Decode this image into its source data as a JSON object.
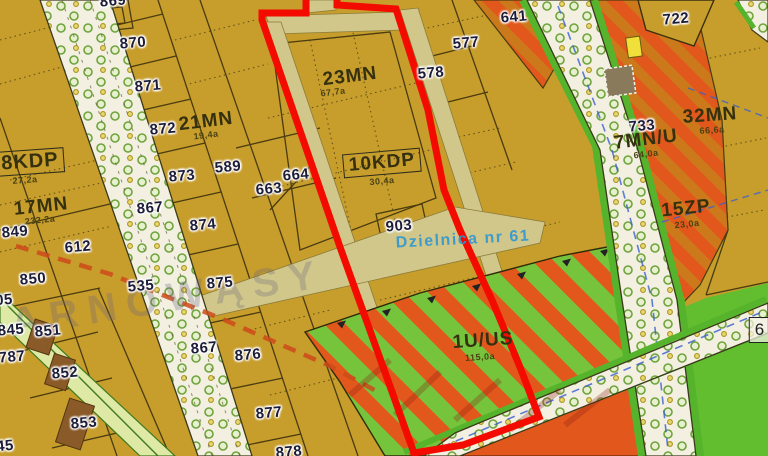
{
  "map": {
    "kind": "zoning-plan-extract",
    "district_note": "Dzielnica nr 61",
    "watermark": "ARNOWĄSY",
    "colors": {
      "parcel_base": "#c79d2c",
      "road_reserve_khaki": "#d2c78a",
      "street_white": "#f3f0e2",
      "service_orange": "#e2581c",
      "sport_green": "#76c43c",
      "park_green": "#62be2f",
      "green_strip": "#55b42c",
      "selection_red": "#f30b00",
      "infra_dash_red": "#cc4a1a",
      "utility_dash_blue": "#3a5fd0",
      "building_brown": "#8a5a28",
      "building_yellow": "#f2e03a",
      "label_blue": "#2896d4"
    },
    "zones": {
      "kdp8": {
        "code": "8KDP",
        "area": "27,2a"
      },
      "mn17": {
        "code": "17MN",
        "area": "232,2a"
      },
      "mn21": {
        "code": "21MN",
        "area": "19,4a"
      },
      "mn23": {
        "code": "23MN",
        "area": "67,7a"
      },
      "kdp10": {
        "code": "10KDP",
        "area": "30,4a"
      },
      "mnu7": {
        "code": "7MN/U",
        "area": "64,0a"
      },
      "mn32": {
        "code": "32MN",
        "area": "66,6a"
      },
      "zp15": {
        "code": "15ZP",
        "area": "23,0a"
      },
      "uus1": {
        "code": "1U/US",
        "area": "115,0a"
      },
      "edge6": {
        "code": "6"
      }
    },
    "parcels": {
      "p869": "869",
      "p870": "870",
      "p871": "871",
      "p872": "872",
      "p873": "873",
      "p874": "874",
      "p875": "875",
      "p876": "876",
      "p877": "877",
      "p878": "878",
      "p589": "589",
      "p663": "663",
      "p664": "664",
      "p867a": "867",
      "p867b": "867",
      "p849": "849",
      "p850": "850",
      "p612": "612",
      "p535": "535",
      "p845": "845",
      "p787": "787",
      "p851": "851",
      "p852": "852",
      "p853": "853",
      "p903": "903",
      "p577": "577",
      "p578": "578",
      "p641": "641",
      "p722": "722",
      "p733": "733",
      "p05": "05",
      "p45": "45"
    }
  }
}
